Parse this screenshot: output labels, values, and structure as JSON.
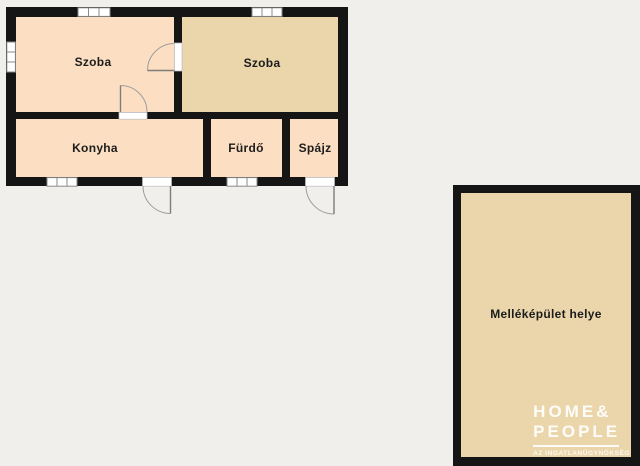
{
  "plan": {
    "rooms": [
      {
        "id": "szoba-left",
        "label": "Szoba"
      },
      {
        "id": "szoba-right",
        "label": "Szoba"
      },
      {
        "id": "konyha",
        "label": "Konyha"
      },
      {
        "id": "furdo",
        "label": "Fürdő"
      },
      {
        "id": "spajz",
        "label": "Spájz"
      },
      {
        "id": "outbuilding",
        "label": "Melléképület helye"
      }
    ]
  },
  "logo": {
    "line1": "HOME&",
    "line2": "PEOPLE",
    "tagline": "AZ INGATLANÜGYNÖKSÉG"
  },
  "colors": {
    "background": "#f0efeb",
    "floor_light": "#fcdfc2",
    "floor_dark": "#ebd6ab",
    "wall": "#151515",
    "logo_text": "#ffffff"
  }
}
